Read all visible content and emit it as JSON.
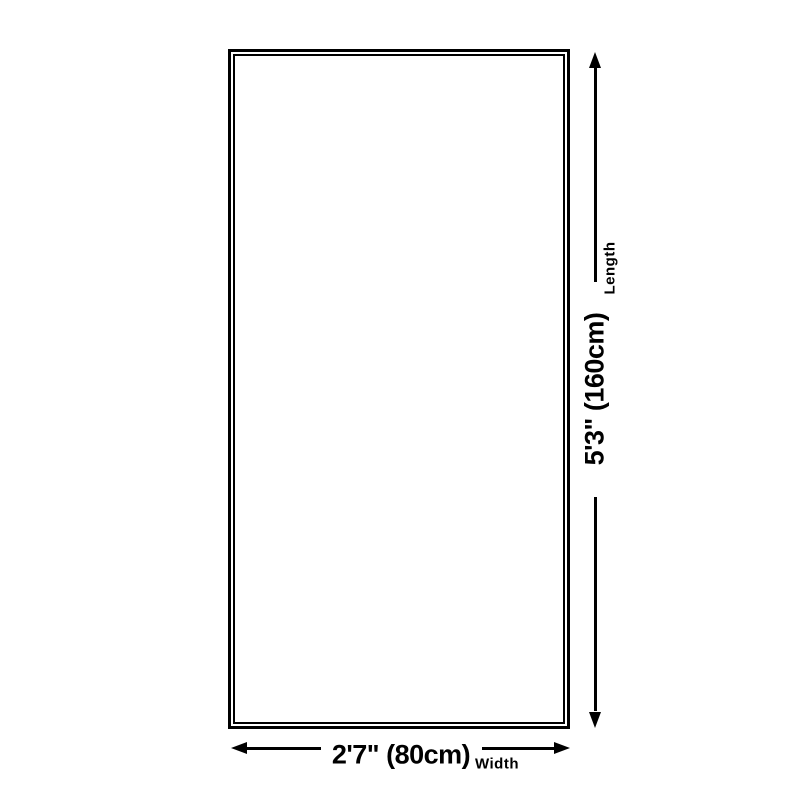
{
  "colors": {
    "bg": "#ffffff",
    "line": "#000000",
    "text": "#000000"
  },
  "dimensions": {
    "length": {
      "value": "5'3\" (160cm)",
      "label": "Length"
    },
    "width": {
      "value": "2'7\" (80cm)",
      "label": "Width"
    }
  }
}
